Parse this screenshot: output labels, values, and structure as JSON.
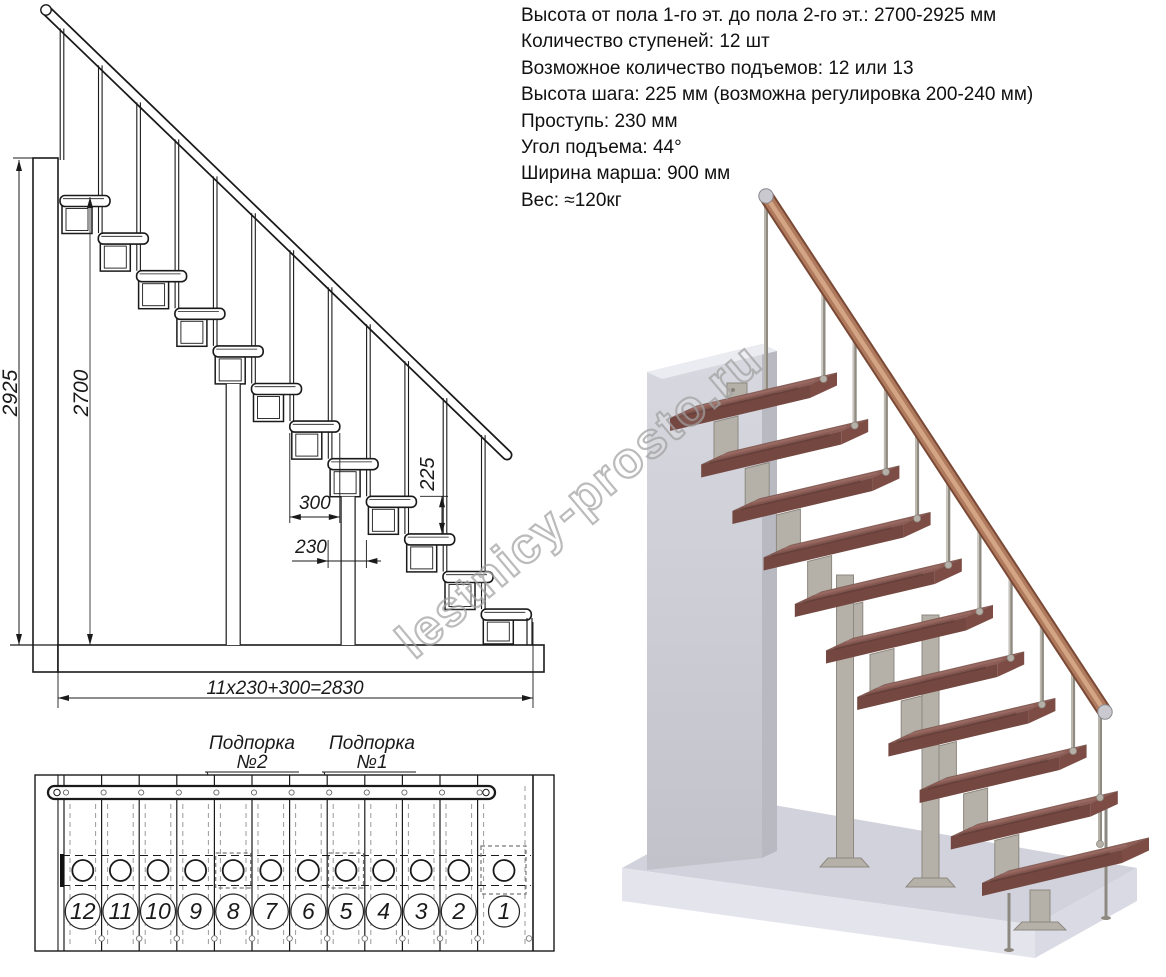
{
  "specs": {
    "lines": [
      "Высота от пола 1-го эт. до пола 2-го эт.: 2700-2925 мм",
      "Количество ступеней: 12 шт",
      "Возможное количество подъемов: 12 или 13",
      "Высота шага: 225 мм (возможна регулировка 200-240 мм)",
      "Проступь: 230 мм",
      "Угол подъема: 44°",
      "Ширина марша: 900 мм",
      "Вес: ≈120кг"
    ]
  },
  "side_view": {
    "step_count": 12,
    "dim_total_height": "2925",
    "dim_floor_height": "2700",
    "dim_tread_depth": "300",
    "dim_step_run": "230",
    "dim_step_rise": "225",
    "dim_total_run": "11x230+300=2830"
  },
  "plan_view": {
    "step_numbers": [
      "12",
      "11",
      "10",
      "9",
      "8",
      "7",
      "6",
      "5",
      "4",
      "3",
      "2",
      "1"
    ],
    "support_2": {
      "line1": "Подпорка",
      "line2": "№2"
    },
    "support_1": {
      "line1": "Подпорка",
      "line2": "№1"
    }
  },
  "render_3d": {
    "colors": {
      "tread_top": "#8e5e56",
      "tread_front": "#744740",
      "tread_side": "#7d4d45",
      "metal_light": "#b5b1a8",
      "metal_dark": "#8d8980",
      "handrail_dark": "#7a4a36",
      "handrail_mid": "#b07a5e",
      "handrail_light": "#d4a584",
      "wall_top": "#ebebf2",
      "wall_face_top": "#d8d8e0",
      "wall_face_bottom": "#c2c2ca",
      "wall_side": "#b9b9c1",
      "floor_top": "#d2d2dc",
      "floor_front": "#e4e4ec",
      "floor_side": "#dadae4",
      "cap_metal": "#c9c9cf"
    }
  },
  "watermark": {
    "text": "lestnicy-prosto.ru"
  }
}
